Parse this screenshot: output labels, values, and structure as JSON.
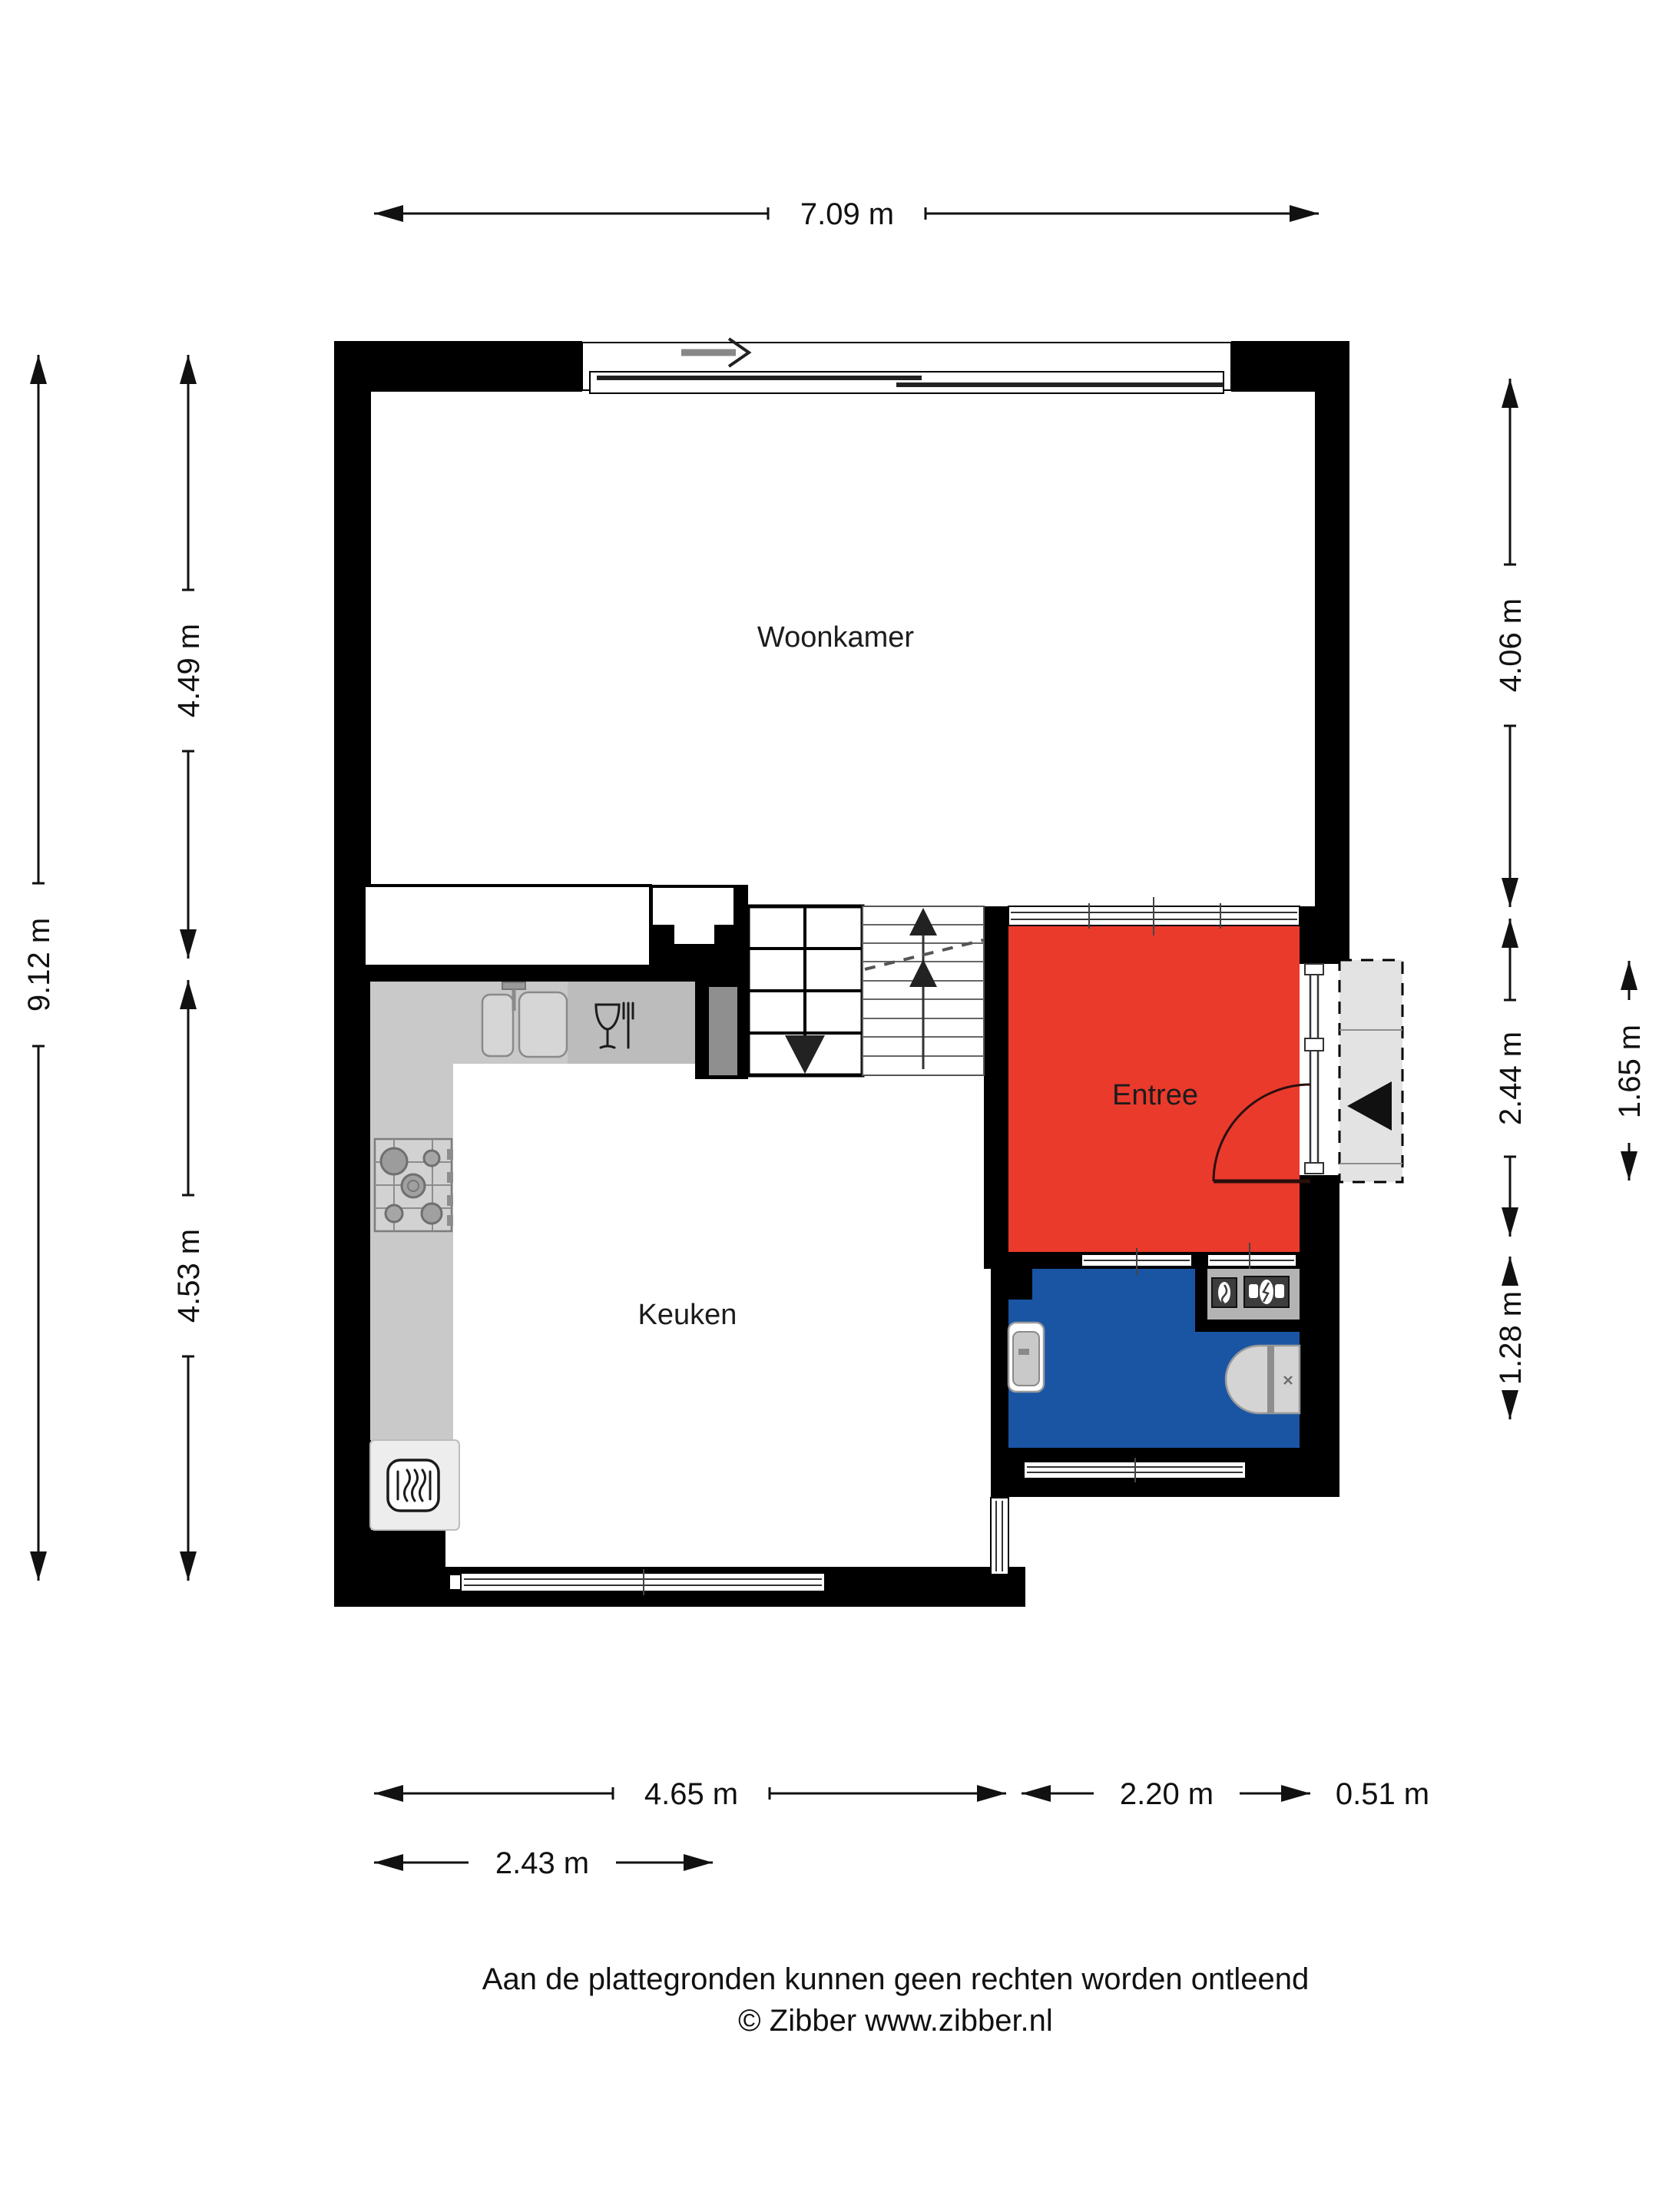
{
  "rooms": {
    "woonkamer": "Woonkamer",
    "keuken": "Keuken",
    "entree": "Entree"
  },
  "dimensions": {
    "top_width": "7.09 m",
    "left_total": "9.12 m",
    "left_upper": "4.49 m",
    "left_lower": "4.53 m",
    "right_upper": "4.06 m",
    "right_entree": "2.44 m",
    "right_porch": "1.65 m",
    "right_toilet": "1.28 m",
    "bottom_kitchen": "4.65 m",
    "bottom_entree": "2.20 m",
    "bottom_porch": "0.51 m",
    "bottom_counter": "2.43 m"
  },
  "footer": {
    "line1": "Aan de plattegronden kunnen geen rechten worden ontleend",
    "line2": "© Zibber www.zibber.nl"
  },
  "colors": {
    "entree": "#ea3a2c",
    "toilet": "#1a55a4",
    "wall": "#000000",
    "counter": "#c9c9c9",
    "counter_dark": "#bcbcbc",
    "porch": "#e3e3e3",
    "niche": "#b3b3b3",
    "cabinet": "#ededed"
  },
  "icons": {
    "entrance_arrow": "left-filled-triangle",
    "stairs_down_arrow": "down-filled-triangle",
    "stairs_up_arrow": "up-filled-triangle",
    "window_slide_arrow": "right-chevron-arrow"
  }
}
